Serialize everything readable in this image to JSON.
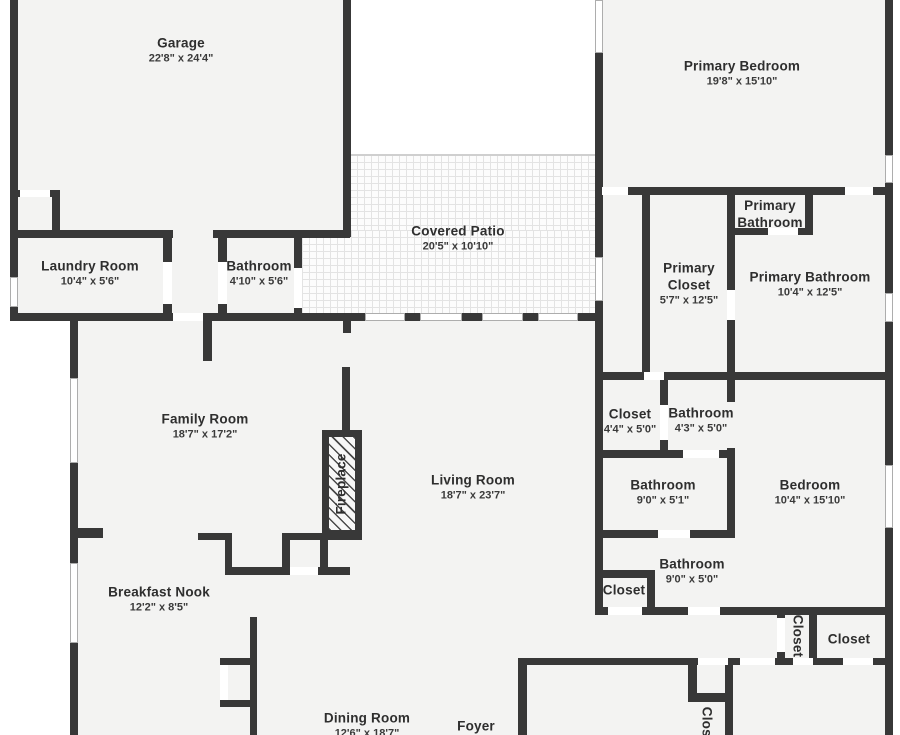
{
  "plan": {
    "title": "Floor plan",
    "colors": {
      "wall": "#383838",
      "room_fill": "#f3f3f2",
      "outside": "#ffffff",
      "patio_tile": "#e3e3e3",
      "text": "#2e2e2e"
    }
  },
  "rooms": [
    {
      "label": "Garage",
      "dims": "22'8\" x 24'4\"",
      "x": 181,
      "y": 51
    },
    {
      "label": "Primary Bedroom",
      "dims": "19'8\" x 15'10\"",
      "x": 742,
      "y": 74
    },
    {
      "label": "Covered Patio",
      "dims": "20'5\" x 10'10\"",
      "x": 458,
      "y": 239
    },
    {
      "label": "Laundry Room",
      "dims": "10'4\" x 5'6\"",
      "x": 90,
      "y": 274
    },
    {
      "label": "Bathroom",
      "dims": "4'10\" x 5'6\"",
      "x": 259,
      "y": 274
    },
    {
      "label": "Primary Bathroom",
      "dims": "",
      "x": 770,
      "y": 215,
      "w": 95
    },
    {
      "label": "Primary Closet",
      "dims": "5'7\" x 12'5\"",
      "x": 689,
      "y": 284,
      "w": 85
    },
    {
      "label": "Primary Bathroom",
      "dims": "10'4\" x 12'5\"",
      "x": 810,
      "y": 285
    },
    {
      "label": "Family Room",
      "dims": "18'7\" x 17'2\"",
      "x": 205,
      "y": 427
    },
    {
      "label": "Living Room",
      "dims": "18'7\" x 23'7\"",
      "x": 473,
      "y": 488
    },
    {
      "label": "Closet",
      "dims": "4'4\" x 5'0\"",
      "x": 630,
      "y": 422
    },
    {
      "label": "Bathroom",
      "dims": "4'3\" x 5'0\"",
      "x": 701,
      "y": 421
    },
    {
      "label": "Bathroom",
      "dims": "9'0\" x 5'1\"",
      "x": 663,
      "y": 493
    },
    {
      "label": "Bedroom",
      "dims": "10'4\" x 15'10\"",
      "x": 810,
      "y": 493
    },
    {
      "label": "Bathroom",
      "dims": "9'0\" x 5'0\"",
      "x": 692,
      "y": 572
    },
    {
      "label": "Closet",
      "dims": "",
      "x": 624,
      "y": 591
    },
    {
      "label": "Closet",
      "dims": "",
      "x": 797,
      "y": 636,
      "rot": 90
    },
    {
      "label": "Closet",
      "dims": "",
      "x": 849,
      "y": 640
    },
    {
      "label": "Breakfast Nook",
      "dims": "12'2\" x 8'5\"",
      "x": 159,
      "y": 600
    },
    {
      "label": "Dining Room",
      "dims": "12'6\" x 18'7\"",
      "x": 367,
      "y": 726
    },
    {
      "label": "Foyer",
      "dims": "",
      "x": 476,
      "y": 727
    },
    {
      "label": "Closet",
      "dims": "",
      "x": 706,
      "y": 728,
      "rot": 90
    }
  ],
  "fireplace": {
    "label": "Fireplace",
    "rect": [
      322,
      430,
      40,
      107
    ]
  },
  "geometry": {
    "fills": [
      [
        10,
        0,
        340,
        237
      ],
      [
        10,
        190,
        340,
        130
      ],
      [
        70,
        313,
        533,
        422
      ],
      [
        595,
        0,
        298,
        735
      ]
    ],
    "patio": [
      [
        350,
        155,
        245,
        76
      ],
      [
        302,
        230,
        293,
        85
      ]
    ],
    "patio_edges": [
      [
        350,
        154,
        245,
        2
      ]
    ],
    "walls": [
      [
        10,
        0,
        8,
        321
      ],
      [
        343,
        0,
        8,
        237
      ],
      [
        10,
        230,
        163,
        8
      ],
      [
        213,
        230,
        137,
        8
      ],
      [
        10,
        190,
        50,
        7
      ],
      [
        52,
        190,
        8,
        47
      ],
      [
        163,
        230,
        9,
        91
      ],
      [
        218,
        230,
        9,
        91
      ],
      [
        294,
        230,
        8,
        91
      ],
      [
        10,
        313,
        593,
        8
      ],
      [
        203,
        313,
        9,
        48
      ],
      [
        595,
        155,
        8,
        166
      ],
      [
        595,
        0,
        8,
        190
      ],
      [
        885,
        0,
        8,
        735
      ],
      [
        595,
        187,
        298,
        8
      ],
      [
        805,
        195,
        8,
        40
      ],
      [
        727,
        228,
        86,
        7
      ],
      [
        642,
        195,
        8,
        177
      ],
      [
        727,
        195,
        8,
        177
      ],
      [
        595,
        372,
        298,
        8
      ],
      [
        660,
        378,
        8,
        72
      ],
      [
        727,
        372,
        8,
        30
      ],
      [
        595,
        450,
        140,
        8
      ],
      [
        727,
        448,
        8,
        90
      ],
      [
        595,
        530,
        140,
        8
      ],
      [
        595,
        321,
        8,
        57
      ],
      [
        595,
        378,
        8,
        160
      ],
      [
        595,
        538,
        8,
        77
      ],
      [
        595,
        570,
        60,
        8
      ],
      [
        647,
        578,
        8,
        37
      ],
      [
        595,
        607,
        140,
        8
      ],
      [
        727,
        607,
        166,
        8
      ],
      [
        777,
        607,
        8,
        58
      ],
      [
        809,
        615,
        8,
        43
      ],
      [
        518,
        658,
        375,
        7
      ],
      [
        518,
        658,
        9,
        77
      ],
      [
        688,
        665,
        9,
        37
      ],
      [
        688,
        693,
        45,
        9
      ],
      [
        725,
        663,
        8,
        72
      ],
      [
        198,
        533,
        34,
        7
      ],
      [
        225,
        540,
        7,
        35
      ],
      [
        225,
        567,
        125,
        8
      ],
      [
        282,
        535,
        8,
        32
      ],
      [
        282,
        533,
        80,
        7
      ],
      [
        320,
        540,
        8,
        35
      ],
      [
        70,
        528,
        33,
        10
      ],
      [
        70,
        320,
        8,
        415
      ],
      [
        343,
        321,
        8,
        12
      ],
      [
        342,
        367,
        8,
        63
      ],
      [
        250,
        617,
        7,
        118
      ],
      [
        220,
        658,
        37,
        7
      ],
      [
        220,
        700,
        37,
        7
      ]
    ],
    "doors": [
      [
        20,
        190,
        30,
        7
      ],
      [
        163,
        262,
        9,
        42
      ],
      [
        218,
        262,
        9,
        42
      ],
      [
        294,
        268,
        8,
        40
      ],
      [
        173,
        313,
        30,
        8
      ],
      [
        602,
        187,
        26,
        8
      ],
      [
        845,
        187,
        28,
        8
      ],
      [
        768,
        228,
        30,
        7
      ],
      [
        727,
        290,
        8,
        30
      ],
      [
        644,
        372,
        20,
        8
      ],
      [
        660,
        405,
        8,
        35
      ],
      [
        683,
        450,
        36,
        8
      ],
      [
        658,
        530,
        32,
        8
      ],
      [
        608,
        607,
        34,
        8
      ],
      [
        688,
        607,
        32,
        8
      ],
      [
        777,
        618,
        8,
        34
      ],
      [
        698,
        658,
        30,
        7
      ],
      [
        740,
        658,
        35,
        7
      ],
      [
        793,
        658,
        20,
        7
      ],
      [
        843,
        658,
        30,
        7
      ],
      [
        290,
        567,
        28,
        8
      ],
      [
        220,
        665,
        8,
        35
      ]
    ],
    "windows": [
      [
        10,
        277,
        8,
        30
      ],
      [
        595,
        0,
        8,
        53
      ],
      [
        885,
        155,
        8,
        28
      ],
      [
        885,
        293,
        8,
        29
      ],
      [
        885,
        465,
        8,
        63
      ],
      [
        70,
        378,
        8,
        85
      ],
      [
        70,
        563,
        8,
        80
      ],
      [
        365,
        313,
        40,
        8
      ],
      [
        420,
        313,
        42,
        8
      ],
      [
        482,
        313,
        41,
        8
      ],
      [
        538,
        313,
        40,
        8
      ],
      [
        595,
        257,
        8,
        44
      ]
    ]
  }
}
